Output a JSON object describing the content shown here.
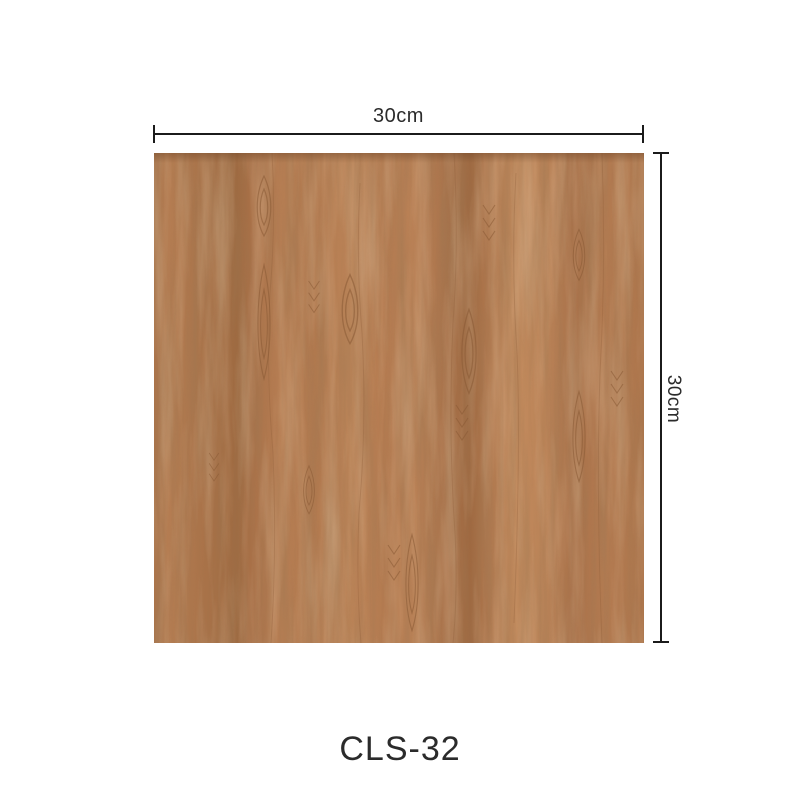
{
  "page": {
    "type": "product-dimension-image",
    "description": "Wood grain square sample with size annotations"
  },
  "product": {
    "model": "CLS-32"
  },
  "dimensions": {
    "width": {
      "label": "30cm"
    },
    "height": {
      "label": "30cm"
    }
  },
  "colors": {
    "background": "#ffffff",
    "dimension_line": "#1b1b1b",
    "label_text": "#2b2b2b",
    "wood_base": "#b37c50",
    "wood_dark": "#9c6840",
    "wood_light": "#c99466",
    "wood_grain_stroke": "#8a5a35"
  }
}
